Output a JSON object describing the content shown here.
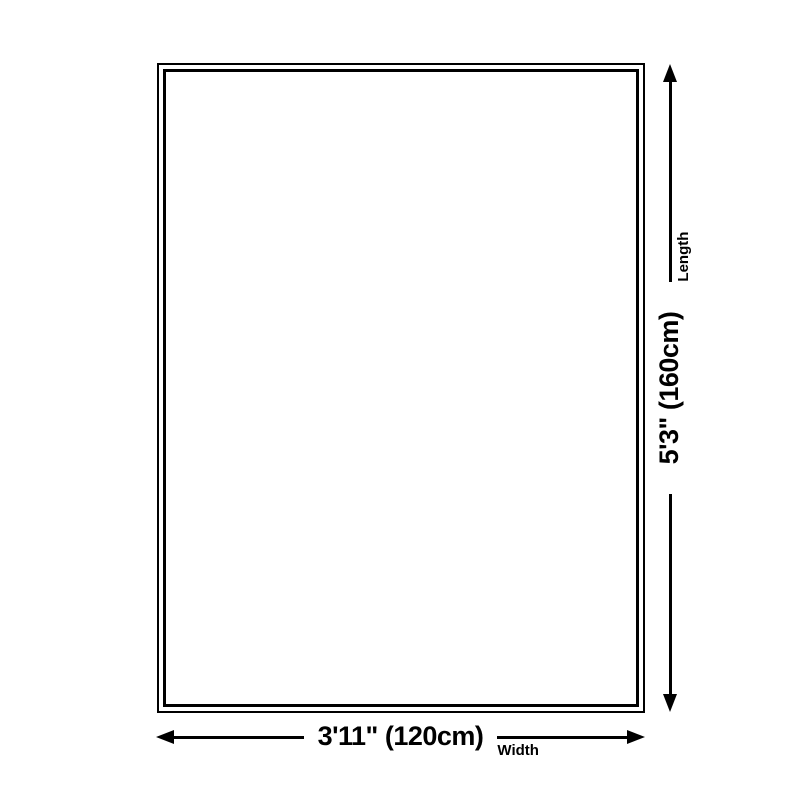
{
  "diagram": {
    "title": "rug size dimension diagram",
    "rug": {
      "shape": "rectangle",
      "border_style": "double"
    },
    "length_arrow": {
      "value": "5'3\" (160cm)",
      "axis_label": "Length",
      "orientation": "vertical"
    },
    "width_arrow": {
      "value": "3'11\" (120cm)",
      "axis_label": "Width",
      "orientation": "horizontal"
    },
    "colors": {
      "line": "#000000",
      "background": "#ffffff",
      "text": "#000000"
    }
  }
}
